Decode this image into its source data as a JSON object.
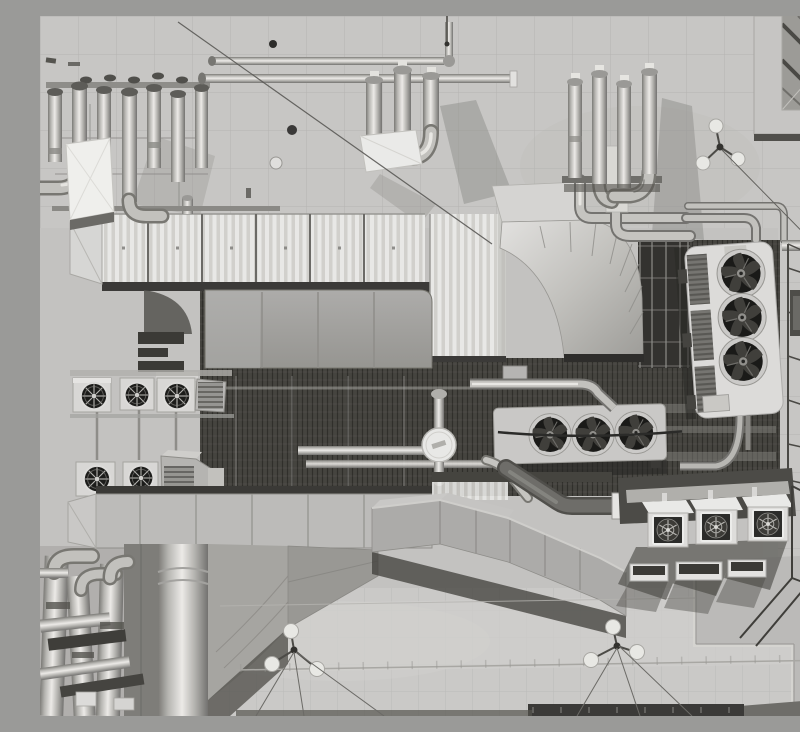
{
  "meta": {
    "title": "Black-and-white aerial top-down photograph of a rooftop HVAC plant with ductwork, exhaust stacks and condenser fan units",
    "style": "grayscale aerial photo",
    "width": 800,
    "height": 700
  },
  "palette": {
    "concrete": "#c3c2c0",
    "concrete_top": "#c7c6c4",
    "concrete_light": "#cac9c7",
    "well": "#45443f",
    "shadow": "#3a3938",
    "metal_bright": "#eceae7",
    "metal_mid": "#b5b4b0",
    "metal_dark": "#7b7a76",
    "white_unit": "#dedddb",
    "fan_dark": "#1a1a18",
    "cable": "#5a5956"
  },
  "scene": {
    "type": "rooftop-hvac-installation",
    "view": "top-down aerial",
    "components": [
      {
        "id": "stack-cluster-left",
        "label": "Cluster of 7 stainless exhaust stacks with rack and white plenum box",
        "count": 7
      },
      {
        "id": "stack-cluster-center",
        "label": "Three silencer stacks on white base",
        "count": 3
      },
      {
        "id": "stack-cluster-right",
        "label": "Four capped exhaust stacks with elbows",
        "count": 4
      },
      {
        "id": "horizontal-pipe-run",
        "label": "Long horizontal service pipes across upper roof",
        "count": 2
      },
      {
        "id": "corrugated-ahu-duct",
        "label": "Large white corrugated supply duct (L-shaped)"
      },
      {
        "id": "ahu-panel-body",
        "label": "Air handling unit casing with smooth access panels"
      },
      {
        "id": "curved-transition-duct",
        "label": "Radial curved sheet-metal transition duct"
      },
      {
        "id": "cooling-enclosure",
        "label": "Caged equipment enclosure"
      },
      {
        "id": "right-condenser-unit",
        "label": "Vertical condenser bank with 3 axial fans",
        "fans": 3
      },
      {
        "id": "center-condenser-unit",
        "label": "Horizontal condenser bank with 3 axial fans",
        "fans": 3
      },
      {
        "id": "left-fan-boxes",
        "label": "Small ventilation boxes with round intake grilles",
        "count": 5
      },
      {
        "id": "bottom-ahu-unit",
        "label": "Second air handling unit casing"
      },
      {
        "id": "sloping-duct",
        "label": "Segmented duct sloping to lower right"
      },
      {
        "id": "exhaust-elbow-pipe",
        "label": "Dark insulated elbow pipe with white flange"
      },
      {
        "id": "descending-ducts",
        "label": "Vertical ducts dropping off lower edge"
      },
      {
        "id": "bottom-left-pipe-cluster",
        "label": "Dense insulated pipe bundle, lower-left corner"
      },
      {
        "id": "rooftop-cube-fans",
        "label": "Three white cube fan units with square grilles",
        "count": 3
      },
      {
        "id": "vent-trays",
        "label": "Three low vent trays with mesh tops",
        "count": 3
      },
      {
        "id": "corner-structure",
        "label": "Parapet corner with diagonal braces, upper right"
      },
      {
        "id": "safety-anchors",
        "label": "Tripod fall-protection anchors with guy cables",
        "count": 3
      },
      {
        "id": "roof-curbs",
        "label": "Concrete expansion joints and stepped curbs"
      }
    ]
  }
}
